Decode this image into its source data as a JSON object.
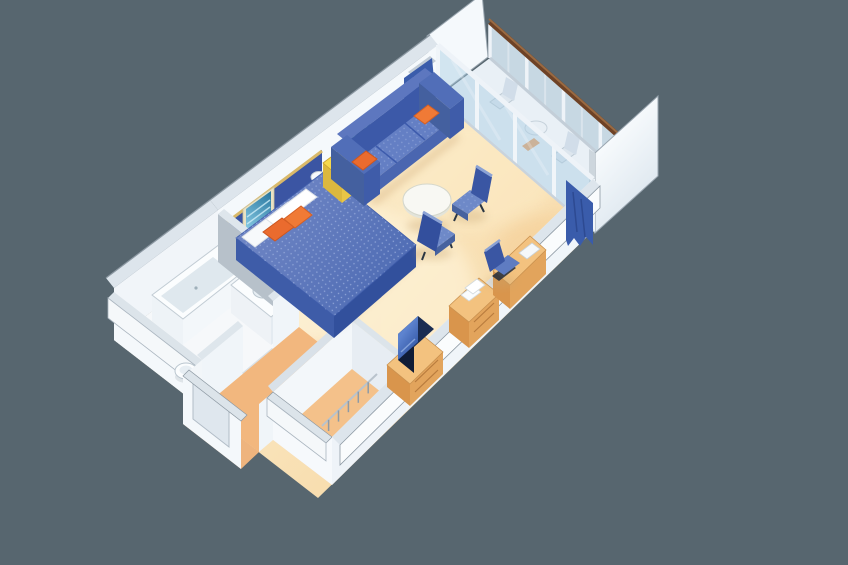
{
  "meta": {
    "description": "3D isometric cutaway illustration of a cruise ship stateroom with private balcony",
    "view": "isometric cutaway, rotated 45 degrees on plain gray background",
    "text_content": "none - illustration only"
  },
  "palette": {
    "background": "#57666f",
    "floor_light": "#fdf3d6",
    "floor_warm": "#f6d5a0",
    "floor_orange": "#f2b77e",
    "wall_white": "#f5f9fc",
    "wall_top": "#dde5ec",
    "wall_shaded": "#b7c1ca",
    "wall_outline": "#8d99a3",
    "headboard_navy": "#3b55a3",
    "bed_blue": "#4b69b2",
    "bed_blue_light": "#7288c6",
    "bed_side": "#32509c",
    "pillow_white": "#f7f9fb",
    "accent_orange": "#ea6b2e",
    "accent_orange_light": "#f07a36",
    "accent_yellow": "#f6d84d",
    "sofa_navy": "#3c59a8",
    "sofa_blue": "#647fc4",
    "chair_blue": "#6e89c8",
    "chair_back_navy": "#3a56a3",
    "wood": "#e2a45c",
    "wood_top": "#f3c27f",
    "wood_dark": "#d9954c",
    "tv_screen": "#2a4d9b",
    "glass_blue": "#a9cbe3",
    "balcony_deck": "#e9f0f6",
    "balustrade_glass": "#d4e4ef",
    "rail_brown": "#6e4226",
    "curtain_blue": "#3a5cab",
    "art_teal": "#2d7ba3"
  },
  "scene": {
    "rooms": [
      {
        "id": "bedroom-sitting-area",
        "label": "Bedroom and sitting area"
      },
      {
        "id": "bathroom",
        "label": "Bathroom with tub, vanity and toilet"
      },
      {
        "id": "entry-corridor",
        "label": "Entry corridor"
      },
      {
        "id": "closet",
        "label": "Walk-in closet with hanger rod"
      },
      {
        "id": "balcony",
        "label": "Private balcony with railing"
      }
    ],
    "furniture": [
      {
        "id": "bed",
        "label": "Queen bed with blue bedspread"
      },
      {
        "id": "bed-pillows",
        "label": "Two orange accent pillows and white pillows"
      },
      {
        "id": "headboard",
        "label": "Navy headboard panel"
      },
      {
        "id": "wall-art-bed",
        "label": "Seascape picture above bed"
      },
      {
        "id": "nightstand",
        "label": "Yellow night table"
      },
      {
        "id": "sofa",
        "label": "Blue three-seat sofa with orange pillows"
      },
      {
        "id": "wall-art-sofa",
        "label": "Framed art above sofa"
      },
      {
        "id": "coffee-table",
        "label": "Round white table"
      },
      {
        "id": "armchair-far",
        "label": "Blue armchair"
      },
      {
        "id": "armchair-near",
        "label": "Blue armchair"
      },
      {
        "id": "desk",
        "label": "Wood desk with chair"
      },
      {
        "id": "dresser",
        "label": "Wood dresser with towels"
      },
      {
        "id": "tv",
        "label": "TV on wood cabinet"
      },
      {
        "id": "bathtub",
        "label": "Bathtub"
      },
      {
        "id": "vanity",
        "label": "Vanity with sink"
      },
      {
        "id": "toilet",
        "label": "Toilet"
      },
      {
        "id": "curtains",
        "label": "Blue curtains at balcony doors"
      },
      {
        "id": "glass-doors",
        "label": "Sliding glass balcony doors"
      },
      {
        "id": "balcony-railing",
        "label": "Glass balustrade with wood handrail"
      },
      {
        "id": "balcony-furniture",
        "label": "Balcony chairs and table"
      }
    ]
  }
}
